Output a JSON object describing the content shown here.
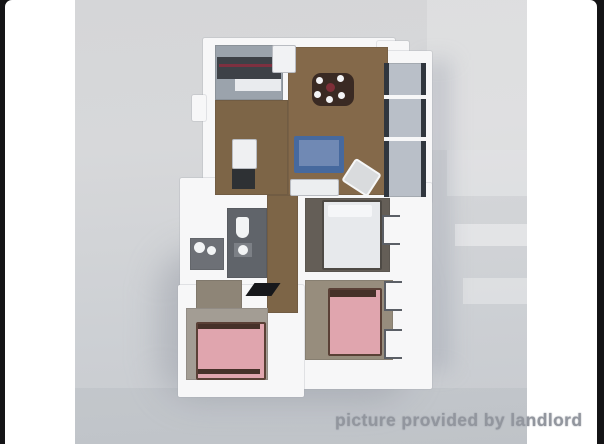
{
  "window": {
    "frame_color": "#141416",
    "page_background": "#ffffff"
  },
  "photo": {
    "background": "#d2d4d7",
    "watermark_text": "picture provided by landlord",
    "watermark_color": "#92969e"
  },
  "floorplan": {
    "walls": {
      "fill": "#f7f7f8",
      "shade": "#d7d8db"
    },
    "rooms": {
      "kitchen": {
        "floor": "#9ba3ac"
      },
      "living_dining": {
        "floor": "#84694a"
      },
      "hallway": {
        "floor": "#7d6547"
      },
      "bathroom_main": {
        "floor": "#60646a"
      },
      "bathroom_second": {
        "floor": "#6d7076"
      },
      "closet": {
        "floor": "#8e8577"
      },
      "bedroom_master": {
        "floor": "#645e57"
      },
      "bedroom_second": {
        "floor": "#978d7d"
      },
      "bedroom_third": {
        "floor": "#a39d94"
      },
      "balcony": {
        "floor": "#b9bfc8"
      }
    },
    "furniture": {
      "counter_top": "#3d4147",
      "counter_accent": "#7d3040",
      "cabinet_front": "#e9ebee",
      "refrigerator": "#f1f2f4",
      "dining_table": "#3a2a23",
      "plate": "#f4f4f6",
      "centerpiece": "#7e2f38",
      "sofa_body": "#46699e",
      "sofa_seat": "#7089b4",
      "coffee_table": "#eceef0",
      "armchair": "#d9dbdd",
      "washer": "#eff0f2",
      "appliance_dark": "#2e3134",
      "fixture_white": "#f2f4f5",
      "sink_counter": "#7c8086",
      "entry_door": "#17181b",
      "bed_white": "#e7e9ec",
      "bed_pillow": "#f5f6f8",
      "bed_pink": "#e0a5ae",
      "bed_frame_dark": "#463129",
      "glass_dark": "#30363e",
      "window_frame": "#5b5f66"
    }
  }
}
